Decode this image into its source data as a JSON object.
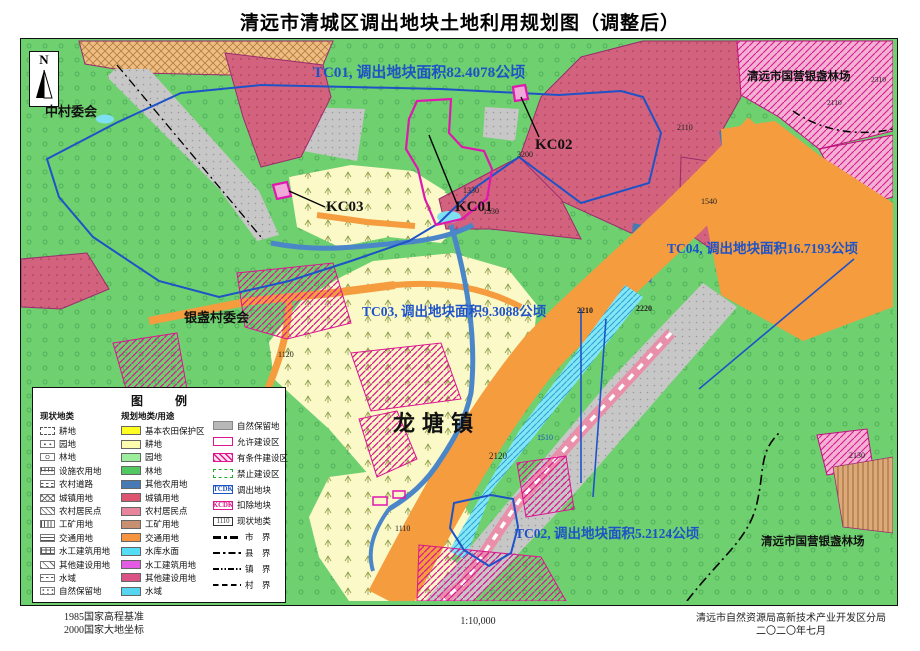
{
  "header": {
    "title": "清远市清城区调出地块土地利用规划图（调整后）"
  },
  "compass": {
    "label": "N"
  },
  "map": {
    "annotations": {
      "tc01": "TC01, 调出地块面积82.4078公顷",
      "tc03": "TC03, 调出地块面积9.3088公顷",
      "tc04": "TC04, 调出地块面积16.7193公顷",
      "tc02": "TC02, 调出地块面积5.2124公顷"
    },
    "kc": {
      "kc01": "KC01",
      "kc02": "KC02",
      "kc03": "KC03"
    },
    "places": {
      "zhongcun": "中村委会",
      "linchang_top": "清远市国营银盏林场",
      "yinzhan": "银盏村委会",
      "longtang": "龙塘镇",
      "linchang_bottom": "清远市国营银盏林场"
    },
    "codes": [
      "3200",
      "1330",
      "1530",
      "2310",
      "2110",
      "2110",
      "1540",
      "2210",
      "2220",
      "1120",
      "1510",
      "2120",
      "1110",
      "2130"
    ]
  },
  "legend": {
    "title": "图　例",
    "col1_header": "现状地类",
    "col2_header": "规划地类/用途",
    "current_types": [
      {
        "label": "耕地",
        "sw": "gengdi"
      },
      {
        "label": "园地",
        "sw": "yuandi"
      },
      {
        "label": "林地",
        "sw": "lindi"
      },
      {
        "label": "设施农用地",
        "sw": "sheshi"
      },
      {
        "label": "农村道路",
        "sw": "daolu"
      },
      {
        "label": "城镇用地",
        "sw": "chengzhen"
      },
      {
        "label": "农村居民点",
        "sw": "jumindian"
      },
      {
        "label": "工矿用地",
        "sw": "gongkuang"
      },
      {
        "label": "交通用地",
        "sw": "jiaotong"
      },
      {
        "label": "水工建筑用地",
        "sw": "shuigong"
      },
      {
        "label": "其他建设用地",
        "sw": "qitajianshe"
      },
      {
        "label": "水域",
        "sw": "shuiyu"
      },
      {
        "label": "自然保留地",
        "sw": "ziranbaoliu"
      }
    ],
    "planned_types": [
      {
        "label": "基本农田保护区",
        "color": "#FFFF22"
      },
      {
        "label": "耕地",
        "color": "#FCFCAE"
      },
      {
        "label": "园地",
        "color": "#9CEE9C"
      },
      {
        "label": "林地",
        "color": "#52C861"
      },
      {
        "label": "其他农用地",
        "color": "#4779B4"
      },
      {
        "label": "城镇用地",
        "color": "#DD5470"
      },
      {
        "label": "农村居民点",
        "color": "#E8849C"
      },
      {
        "label": "工矿用地",
        "color": "#C89070"
      },
      {
        "label": "交通用地",
        "color": "#F79440"
      },
      {
        "label": "水库水面",
        "color": "#55DDF5"
      },
      {
        "label": "水工建筑用地",
        "color": "#E35BE3"
      },
      {
        "label": "其他建设用地",
        "color": "#DB5286"
      },
      {
        "label": "水域",
        "color": "#55D5F0"
      }
    ],
    "zone_items": [
      {
        "label": "自然保留地",
        "sw": "gray"
      },
      {
        "label": "允许建设区",
        "sw": "allow"
      },
      {
        "label": "有条件建设区",
        "sw": "cond"
      },
      {
        "label": "禁止建设区",
        "sw": "forbid"
      },
      {
        "label": "调出地块",
        "sw": "tcdk",
        "tag": "TCDK"
      },
      {
        "label": "扣除地块",
        "sw": "kcdk",
        "tag": "KCDK"
      },
      {
        "label": "现状地类",
        "sw": "code",
        "tag": "1110"
      },
      {
        "label": "市　界",
        "sw": "line-shi"
      },
      {
        "label": "县　界",
        "sw": "line-xian"
      },
      {
        "label": "镇　界",
        "sw": "line-zhen"
      },
      {
        "label": "村　界",
        "sw": "line-cun"
      }
    ]
  },
  "footer": {
    "datum1": "1985国家高程基准",
    "datum2": "2000国家大地坐标",
    "scale": "1:10,000",
    "agency": "清远市自然资源局高新技术产业开发区分局",
    "date": "二〇二〇年七月"
  }
}
